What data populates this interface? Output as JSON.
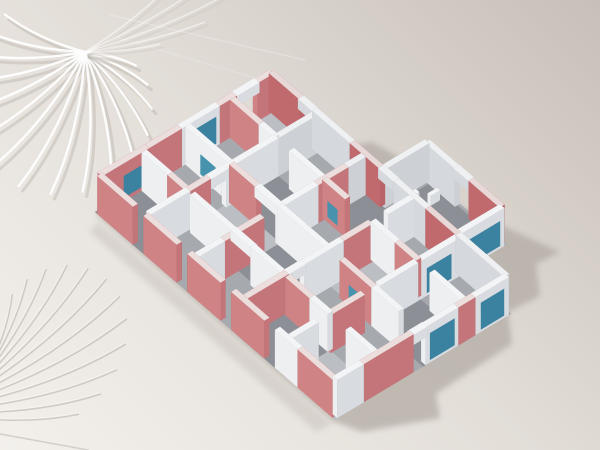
{
  "scene": {
    "canvas": {
      "width": 600,
      "height": 450
    },
    "background": {
      "bottom_left": "#f3f0ec",
      "middle": "#e2ddd7",
      "top_right": "#c7c0b8"
    },
    "projection": {
      "ox": 95,
      "oy": 212,
      "ux": 0.858,
      "uy": -0.514,
      "vx": 0.756,
      "vy": 0.655,
      "wall_height": 38,
      "wall_thickness": 6
    },
    "palette": {
      "w": {
        "top": "#f3f4f6",
        "sw": "#edeff1",
        "se": "#d8dbdf",
        "ne": "#abb1b9",
        "nw": "#a5abb3"
      },
      "wi": {
        "top": "#eff0f2",
        "sw": "#d5d8dc",
        "se": "#cdd1d5",
        "ne": "#a5abb3",
        "nw": "#9fa5ad"
      },
      "r": {
        "top": "#ecdedd",
        "sw": "#d08384",
        "se": "#c47579",
        "ne": "#a65c60",
        "nw": "#9f565a"
      },
      "ri": {
        "top": "#e8d8d8",
        "sw": "#c06a6e",
        "se": "#b96468",
        "ne": "#9b5256",
        "nw": "#944d51"
      },
      "teal": {
        "se": "#3b82a0",
        "sw": "#4793ae",
        "ne": "#2f6f8a",
        "nw": "#2f6f8a"
      },
      "floor_slab": "#a6aaaf",
      "floor_dark": "#8c9096",
      "floor_light": "#bbbec2",
      "ground_shadow": "#b0a9a2",
      "frond_shadow": "#b3ada6",
      "frond_light": "#ffffff"
    },
    "shadow": {
      "blur": 3,
      "main": {
        "opacity": 0.7,
        "points": [
          [
            272,
            106
          ],
          [
            340,
            148
          ],
          [
            372,
            142
          ],
          [
            452,
            186
          ],
          [
            446,
            200
          ],
          [
            560,
            252
          ],
          [
            536,
            264
          ],
          [
            540,
            296
          ],
          [
            508,
            312
          ],
          [
            512,
            344
          ],
          [
            436,
            394
          ],
          [
            440,
            418
          ],
          [
            362,
            432
          ],
          [
            333,
            421
          ],
          [
            240,
            341
          ],
          [
            150,
            262
          ],
          [
            96,
            214
          ],
          [
            180,
            152
          ]
        ]
      },
      "strip": {
        "opacity": 0.3,
        "points": [
          [
            98,
            222
          ],
          [
            332,
            424
          ],
          [
            316,
            432
          ],
          [
            90,
            232
          ]
        ]
      }
    },
    "floors": {
      "slabs": [
        [
          [
            0,
            0
          ],
          [
            206,
            0
          ],
          [
            206,
            317
          ],
          [
            0,
            317
          ]
        ],
        [
          [
            203,
            150
          ],
          [
            258,
            150
          ],
          [
            258,
            252
          ],
          [
            203,
            252
          ]
        ]
      ],
      "dark": [
        [
          0,
          0,
          52,
          64
        ],
        [
          103,
          64,
          155,
          128
        ],
        [
          52,
          128,
          103,
          192
        ],
        [
          155,
          128,
          203,
          192
        ],
        [
          0,
          192,
          52,
          252
        ],
        [
          103,
          252,
          155,
          317
        ],
        [
          206,
          155,
          255,
          249
        ]
      ],
      "light": [
        [
          52,
          64,
          103,
          128
        ],
        [
          155,
          0,
          203,
          64
        ],
        [
          103,
          192,
          155,
          252
        ],
        [
          0,
          252,
          52,
          317
        ]
      ]
    },
    "walls": [
      {
        "a": [
          3,
          3
        ],
        "b": [
          58,
          3
        ],
        "c": "r",
        "pane": {
          "s": "pos",
          "f": [
            0.45,
            0.9
          ],
          "z": [
            4,
            26
          ]
        }
      },
      {
        "a": [
          58,
          3
        ],
        "b": [
          96,
          3
        ],
        "c": "r"
      },
      {
        "a": [
          96,
          3
        ],
        "b": [
          140,
          3
        ],
        "c": "w",
        "pane": {
          "s": "pos",
          "f": [
            0.1,
            0.9
          ],
          "z": [
            3,
            30
          ]
        }
      },
      {
        "a": [
          140,
          3
        ],
        "b": [
          160,
          3
        ],
        "c": "r"
      },
      {
        "a": [
          158,
          3
        ],
        "b": [
          186,
          3
        ],
        "c": "w",
        "z0": 28,
        "h": 10,
        "t": 7
      },
      {
        "a": [
          184,
          3
        ],
        "b": [
          203,
          3
        ],
        "c": "r"
      },
      {
        "a": [
          203,
          3
        ],
        "b": [
          203,
          44
        ],
        "c": "ri"
      },
      {
        "a": [
          203,
          42
        ],
        "b": [
          203,
          62
        ],
        "c": "wi",
        "z0": 28,
        "h": 10,
        "t": 7
      },
      {
        "a": [
          203,
          60
        ],
        "b": [
          203,
          110
        ],
        "c": "wi"
      },
      {
        "a": [
          203,
          110
        ],
        "b": [
          203,
          150
        ],
        "c": "ri"
      },
      {
        "a": [
          203,
          148
        ],
        "b": [
          203,
          170
        ],
        "c": "wi",
        "z0": 28,
        "h": 10,
        "t": 7
      },
      {
        "a": [
          203,
          168
        ],
        "b": [
          203,
          210
        ],
        "c": "wi"
      },
      {
        "a": [
          203,
          210
        ],
        "b": [
          203,
          250
        ],
        "c": "ri"
      },
      {
        "a": [
          203,
          250
        ],
        "b": [
          203,
          314
        ],
        "c": "wi"
      },
      {
        "a": [
          203,
          150
        ],
        "b": [
          255,
          150
        ],
        "c": "wi"
      },
      {
        "a": [
          255,
          150
        ],
        "b": [
          255,
          190
        ],
        "c": "wi"
      },
      {
        "a": [
          255,
          188
        ],
        "b": [
          255,
          210
        ],
        "c": "wi",
        "z0": 28,
        "h": 10,
        "t": 7
      },
      {
        "a": [
          255,
          208
        ],
        "b": [
          255,
          249
        ],
        "c": "ri"
      },
      {
        "a": [
          203,
          249
        ],
        "b": [
          255,
          249
        ],
        "c": "w",
        "pane": {
          "s": "pos",
          "f": [
            0.2,
            0.9
          ],
          "z": [
            3,
            28
          ]
        }
      },
      {
        "a": [
          215,
          162
        ],
        "b": [
          233,
          162
        ],
        "c": "w",
        "t": 5,
        "h": 8
      },
      {
        "a": [
          236,
          174
        ],
        "b": [
          247,
          174
        ],
        "c": "w",
        "t": 4,
        "h": 10
      },
      {
        "a": [
          3,
          314
        ],
        "b": [
          34,
          314
        ],
        "c": "w"
      },
      {
        "a": [
          34,
          314
        ],
        "b": [
          92,
          314
        ],
        "c": "r"
      },
      {
        "a": [
          90,
          314
        ],
        "b": [
          108,
          314
        ],
        "c": "w",
        "z0": 28,
        "h": 10,
        "t": 7
      },
      {
        "a": [
          106,
          314
        ],
        "b": [
          144,
          314
        ],
        "c": "w",
        "pane": {
          "s": "pos",
          "f": [
            0.12,
            0.88
          ],
          "z": [
            3,
            30
          ]
        }
      },
      {
        "a": [
          144,
          314
        ],
        "b": [
          164,
          314
        ],
        "c": "r"
      },
      {
        "a": [
          164,
          314
        ],
        "b": [
          203,
          314
        ],
        "c": "w",
        "pane": {
          "s": "pos",
          "f": [
            0.15,
            0.85
          ],
          "z": [
            3,
            30
          ]
        }
      },
      {
        "a": [
          3,
          3
        ],
        "b": [
          3,
          50
        ],
        "c": "r"
      },
      {
        "a": [
          3,
          64
        ],
        "b": [
          3,
          108
        ],
        "c": "r"
      },
      {
        "a": [
          3,
          122
        ],
        "b": [
          3,
          166
        ],
        "c": "r"
      },
      {
        "a": [
          3,
          180
        ],
        "b": [
          3,
          224
        ],
        "c": "r"
      },
      {
        "a": [
          3,
          238
        ],
        "b": [
          3,
          268
        ],
        "c": "w"
      },
      {
        "a": [
          3,
          268
        ],
        "b": [
          3,
          314
        ],
        "c": "r"
      },
      {
        "a": [
          6,
          64
        ],
        "b": [
          52,
          64
        ],
        "c": "w"
      },
      {
        "a": [
          52,
          64
        ],
        "b": [
          76,
          64
        ],
        "c": "r"
      },
      {
        "a": [
          74,
          64
        ],
        "b": [
          96,
          64
        ],
        "c": "w",
        "z0": 28,
        "h": 10,
        "t": 7
      },
      {
        "a": [
          94,
          64
        ],
        "b": [
          155,
          64
        ],
        "c": "w"
      },
      {
        "a": [
          155,
          64
        ],
        "b": [
          200,
          64
        ],
        "c": "wi"
      },
      {
        "a": [
          6,
          128
        ],
        "b": [
          36,
          128
        ],
        "c": "w"
      },
      {
        "a": [
          36,
          128
        ],
        "b": [
          82,
          128
        ],
        "c": "r"
      },
      {
        "a": [
          100,
          128
        ],
        "b": [
          145,
          128
        ],
        "c": "w"
      },
      {
        "a": [
          145,
          128
        ],
        "b": [
          180,
          128
        ],
        "c": "r"
      },
      {
        "a": [
          180,
          128
        ],
        "b": [
          200,
          128
        ],
        "c": "wi"
      },
      {
        "a": [
          6,
          192
        ],
        "b": [
          54,
          192
        ],
        "c": "r"
      },
      {
        "a": [
          52,
          192
        ],
        "b": [
          74,
          192
        ],
        "c": "w",
        "z0": 28,
        "h": 10,
        "t": 7
      },
      {
        "a": [
          72,
          192
        ],
        "b": [
          118,
          192
        ],
        "c": "w"
      },
      {
        "a": [
          118,
          192
        ],
        "b": [
          152,
          192
        ],
        "c": "r"
      },
      {
        "a": [
          170,
          192
        ],
        "b": [
          200,
          192
        ],
        "c": "w"
      },
      {
        "a": [
          6,
          252
        ],
        "b": [
          36,
          252
        ],
        "c": "w"
      },
      {
        "a": [
          50,
          252
        ],
        "b": [
          90,
          252
        ],
        "c": "r"
      },
      {
        "a": [
          108,
          252
        ],
        "b": [
          152,
          252
        ],
        "c": "w"
      },
      {
        "a": [
          152,
          252
        ],
        "b": [
          200,
          252
        ],
        "c": "w",
        "pane": {
          "s": "pos",
          "f": [
            0.2,
            0.8
          ],
          "z": [
            3,
            28
          ]
        }
      },
      {
        "a": [
          52,
          6
        ],
        "b": [
          52,
          40
        ],
        "c": "w"
      },
      {
        "a": [
          52,
          40
        ],
        "b": [
          52,
          64
        ],
        "c": "r"
      },
      {
        "a": [
          52,
          70
        ],
        "b": [
          52,
          126
        ],
        "c": "w"
      },
      {
        "a": [
          52,
          124
        ],
        "b": [
          52,
          152
        ],
        "c": "w",
        "z0": 28,
        "h": 10,
        "t": 7
      },
      {
        "a": [
          52,
          150
        ],
        "b": [
          52,
          192
        ],
        "c": "w"
      },
      {
        "a": [
          52,
          196
        ],
        "b": [
          52,
          228
        ],
        "c": "r"
      },
      {
        "a": [
          52,
          228
        ],
        "b": [
          52,
          252
        ],
        "c": "w"
      },
      {
        "a": [
          52,
          276
        ],
        "b": [
          52,
          314
        ],
        "c": "w"
      },
      {
        "a": [
          103,
          6
        ],
        "b": [
          103,
          64
        ],
        "c": "w",
        "pane": {
          "s": "pos",
          "f": [
            0.35,
            0.7
          ],
          "z": [
            4,
            24
          ]
        }
      },
      {
        "a": [
          103,
          64
        ],
        "b": [
          103,
          100
        ],
        "c": "r"
      },
      {
        "a": [
          103,
          98
        ],
        "b": [
          103,
          130
        ],
        "c": "w",
        "z0": 28,
        "h": 10,
        "t": 7
      },
      {
        "a": [
          103,
          128
        ],
        "b": [
          103,
          192
        ],
        "c": "w"
      },
      {
        "a": [
          103,
          210
        ],
        "b": [
          103,
          252
        ],
        "c": "r",
        "pane": {
          "s": "pos",
          "f": [
            0.3,
            0.6
          ],
          "z": [
            6,
            22
          ]
        }
      },
      {
        "a": [
          103,
          252
        ],
        "b": [
          103,
          288
        ],
        "c": "w"
      },
      {
        "a": [
          155,
          6
        ],
        "b": [
          155,
          44
        ],
        "c": "r"
      },
      {
        "a": [
          155,
          44
        ],
        "b": [
          155,
          64
        ],
        "c": "w"
      },
      {
        "a": [
          155,
          84
        ],
        "b": [
          155,
          128
        ],
        "c": "w"
      },
      {
        "a": [
          155,
          128
        ],
        "b": [
          155,
          158
        ],
        "c": "r",
        "pane": {
          "s": "pos",
          "f": [
            0.25,
            0.7
          ],
          "z": [
            6,
            22
          ]
        }
      },
      {
        "a": [
          155,
          192
        ],
        "b": [
          155,
          224
        ],
        "c": "w"
      },
      {
        "a": [
          155,
          224
        ],
        "b": [
          155,
          252
        ],
        "c": "r"
      },
      {
        "a": [
          155,
          270
        ],
        "b": [
          155,
          314
        ],
        "c": "w"
      }
    ],
    "fronds": [
      {
        "layer": "a",
        "rachis": [
          [
            85,
            52
          ],
          [
            85,
            52
          ]
        ],
        "n": 16,
        "a0": 205,
        "a1": 15,
        "len": 150,
        "min": 0.35,
        "curve": -10,
        "strokes": [
          {
            "color": "#b4aea7",
            "w": 3,
            "op": 0.4,
            "dx": 4,
            "dy": 5
          },
          {
            "color": "#ffffff",
            "w": 2.4,
            "op": 0.92
          }
        ]
      },
      {
        "layer": "a",
        "rachis": [
          [
            85,
            52
          ],
          [
            85,
            52
          ]
        ],
        "n": 5,
        "a0": -38,
        "a1": -6,
        "len": 150,
        "min": 0.5,
        "curve": 6,
        "strokes": [
          {
            "color": "#c6c0b9",
            "w": 2,
            "op": 0.3,
            "dx": 3,
            "dy": 3
          },
          {
            "color": "#ffffff",
            "w": 1.6,
            "op": 0.5
          }
        ]
      },
      {
        "layer": "b",
        "rachis": [
          [
            -24,
            418
          ],
          [
            -6,
            358
          ]
        ],
        "n": 12,
        "a0": -2,
        "a1": -74,
        "len": 165,
        "min": 0.4,
        "curve": 8,
        "strokes": [
          {
            "color": "#b3ada6",
            "w": 1.5,
            "op": 0.55
          },
          {
            "color": "#ffffff",
            "w": 1,
            "op": 0.35,
            "dx": -1,
            "dy": -1.5
          }
        ]
      }
    ],
    "streaks": [
      {
        "a": [
          0,
          434
        ],
        "b": [
          88,
          450
        ],
        "color": "#b3ada6",
        "w": 1.4,
        "op": 0.5
      },
      {
        "a": [
          110,
          15
        ],
        "b": [
          305,
          60
        ],
        "color": "#ffffff",
        "w": 1.2,
        "op": 0.25
      },
      {
        "a": [
          118,
          38
        ],
        "b": [
          280,
          85
        ],
        "color": "#ffffff",
        "w": 1,
        "op": 0.2
      }
    ]
  }
}
